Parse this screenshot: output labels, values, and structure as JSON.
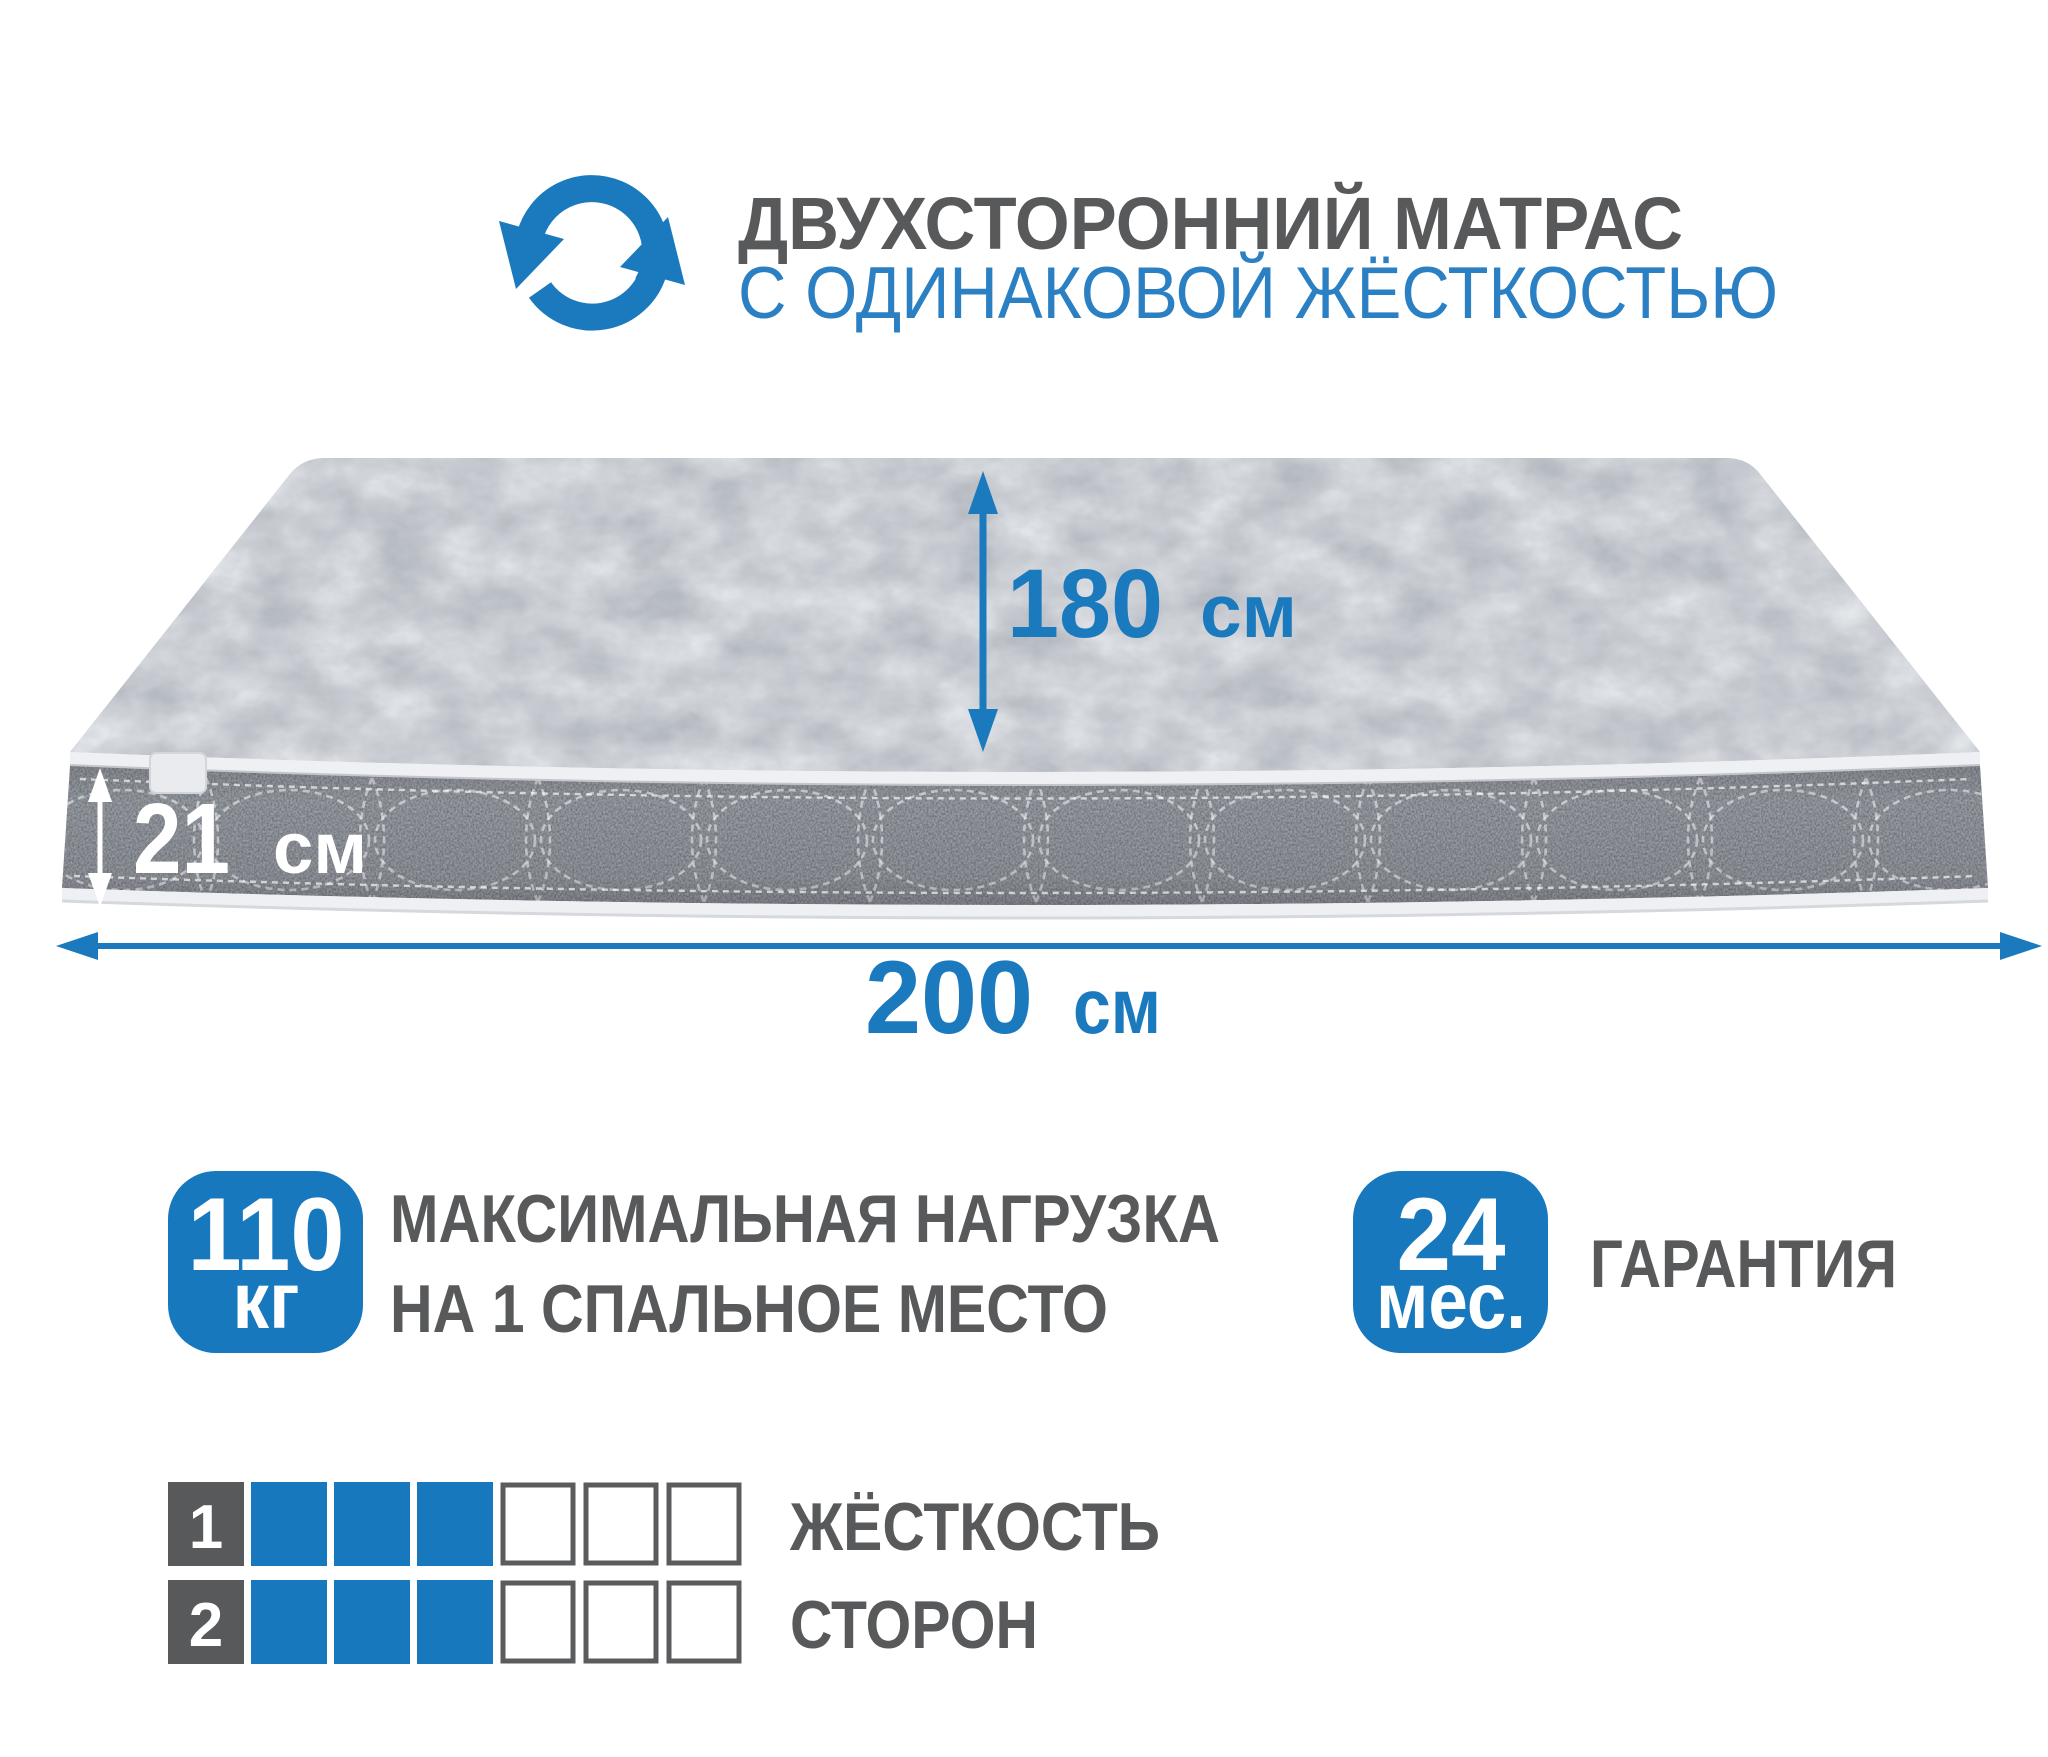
{
  "colors": {
    "accent": "#1b7abe",
    "text_gray": "#58595b",
    "mattress_top": "#b5bac1",
    "mattress_side": "#70757d",
    "piping_white": "#eef0f3"
  },
  "header": {
    "icon": "rotate-arrows-icon",
    "title": "ДВУХСТОРОННИЙ МАТРАС",
    "subtitle": "С ОДИНАКОВОЙ ЖЁСТКОСТЬЮ"
  },
  "dimensions": {
    "width": {
      "value": "180",
      "unit": "см"
    },
    "height": {
      "value": "21",
      "unit": "см"
    },
    "length": {
      "value": "200",
      "unit": "см"
    }
  },
  "features": {
    "max_load": {
      "value": "110",
      "unit": "кг",
      "label_line1": "МАКСИМАЛЬНАЯ НАГРУЗКА",
      "label_line2": "НА 1 СПАЛЬНОЕ МЕСТО"
    },
    "warranty": {
      "value": "24",
      "unit": "мес.",
      "label": "ГАРАНТИЯ"
    }
  },
  "firmness": {
    "label_line1": "ЖЁСТКОСТЬ",
    "label_line2": "СТОРОН",
    "scale_max": 6,
    "rows": [
      {
        "side": "1",
        "filled": 3
      },
      {
        "side": "2",
        "filled": 3
      }
    ]
  }
}
